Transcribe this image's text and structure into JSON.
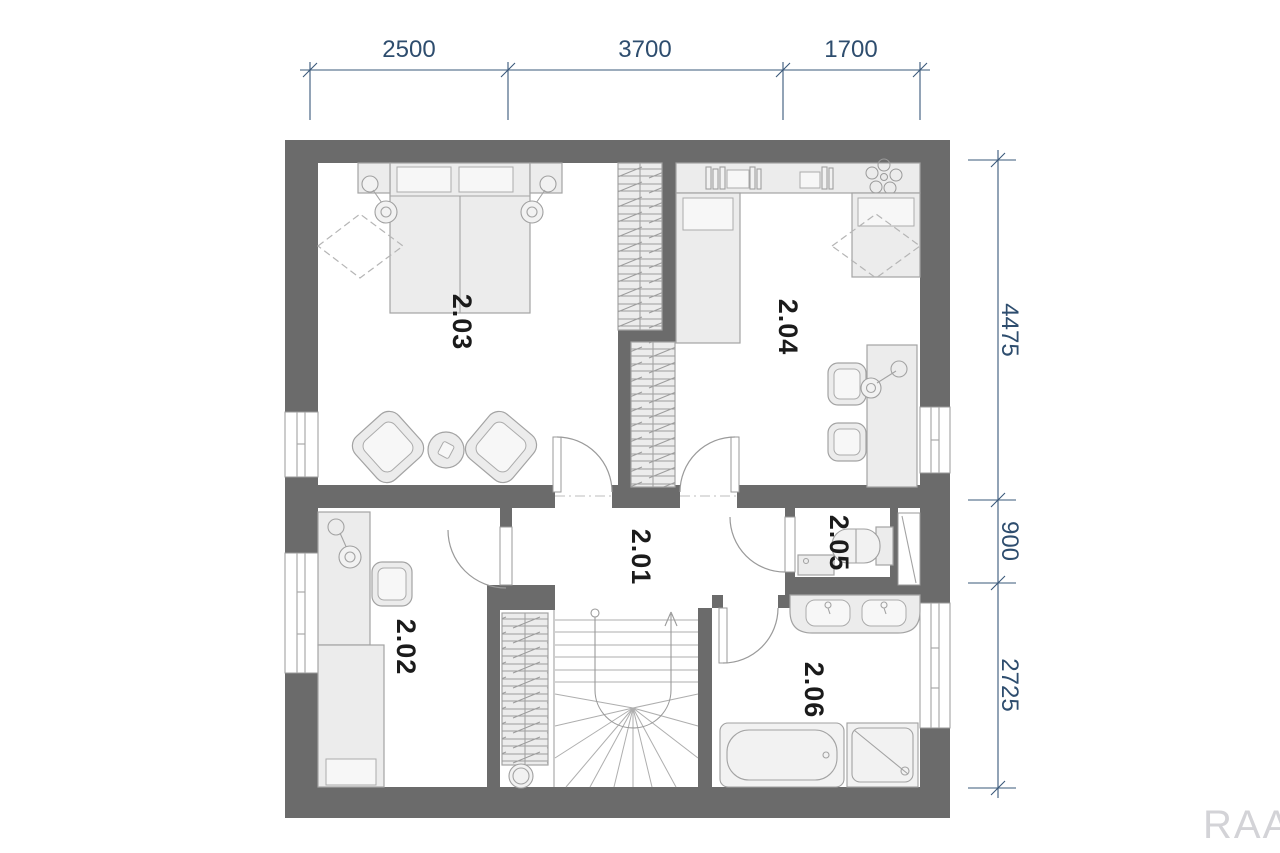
{
  "plan": {
    "type": "floor-plan",
    "watermark": "RAA",
    "rooms": [
      {
        "label": "2.01"
      },
      {
        "label": "2.02"
      },
      {
        "label": "2.03"
      },
      {
        "label": "2.04"
      },
      {
        "label": "2.05"
      },
      {
        "label": "2.06"
      }
    ],
    "dimensions": {
      "top": [
        "2500",
        "3700",
        "1700"
      ],
      "right": [
        "4475",
        "900",
        "2725"
      ]
    },
    "colors": {
      "wall": "#6b6b6b",
      "dimension": "#2e4d6e",
      "room_label": "#1b1b1b",
      "furniture_fill": "#ececec",
      "furniture_stroke": "#a3a3a3",
      "door_arc": "#9a9a9a",
      "hatch": "#9d9d9d",
      "watermark": "#d3d3d7"
    }
  }
}
